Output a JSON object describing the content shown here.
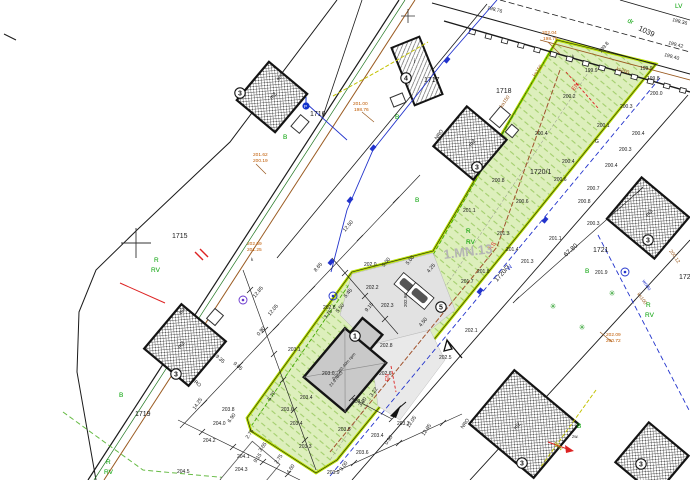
{
  "zone": {
    "label": "1.MN.13",
    "color": "#b5b5b5"
  },
  "parcels": [
    {
      "number": "1715"
    },
    {
      "number": "1716"
    },
    {
      "number": "1717"
    },
    {
      "number": "1718"
    },
    {
      "number": "1719"
    },
    {
      "number": "1720/1"
    },
    {
      "number": "1720/7"
    },
    {
      "number": "1721"
    },
    {
      "number": "1039"
    },
    {
      "number": "172"
    }
  ],
  "colors": {
    "line_black": "#1a1a1a",
    "parcel_green_fill": "#ddefbc",
    "parcel_green_border": "#b7e000",
    "landuse_green_text": "#00a000",
    "benchmark_orange": "#c05a00",
    "utility_blue": "#2233cc",
    "utility_brown": "#9a5a20",
    "utility_red": "#dd2222",
    "utility_yellow": "#c2c200",
    "building_gray": "#c9c9c9"
  },
  "building_markers": [
    {
      "n": "3",
      "x": 240,
      "y": 93
    },
    {
      "n": "3",
      "x": 176,
      "y": 374
    },
    {
      "n": "3",
      "x": 477,
      "y": 167
    },
    {
      "n": "4",
      "x": 406,
      "y": 78
    },
    {
      "n": "3",
      "x": 648,
      "y": 240
    },
    {
      "n": "3",
      "x": 522,
      "y": 463
    },
    {
      "n": "3",
      "x": 641,
      "y": 464
    },
    {
      "n": "1",
      "x": 355,
      "y": 336
    },
    {
      "n": "5",
      "x": 441,
      "y": 307
    }
  ],
  "trees": [
    {
      "x": 553,
      "y": 309
    },
    {
      "x": 612,
      "y": 296
    },
    {
      "x": 582,
      "y": 330
    }
  ],
  "well_symbols": [
    {
      "x": 243,
      "y": 300,
      "c": "#6633cc"
    },
    {
      "x": 625,
      "y": 272,
      "c": "#2233cc"
    },
    {
      "x": 333,
      "y": 296,
      "c": "#2233cc"
    }
  ],
  "valves": [
    {
      "x": 447,
      "y": 60
    },
    {
      "x": 373,
      "y": 148
    },
    {
      "x": 350,
      "y": 200
    },
    {
      "x": 545,
      "y": 220
    },
    {
      "x": 480,
      "y": 291
    },
    {
      "x": 331,
      "y": 262
    }
  ],
  "labels": [
    {
      "t": "198.76",
      "x": 487,
      "y": 9,
      "r": 15
    },
    {
      "t": "198.36",
      "x": 672,
      "y": 21,
      "r": 15
    },
    {
      "t": "199.42",
      "x": 668,
      "y": 44,
      "r": 15
    },
    {
      "t": "199.40",
      "x": 664,
      "y": 56,
      "r": 15
    },
    {
      "t": "199.8",
      "x": 601,
      "y": 53,
      "r": -50
    },
    {
      "t": "199.9",
      "x": 585,
      "y": 72
    },
    {
      "t": "199.9",
      "x": 640,
      "y": 70
    },
    {
      "t": "199.8",
      "x": 647,
      "y": 80
    },
    {
      "t": "200.0",
      "x": 650,
      "y": 95
    },
    {
      "t": "200.3",
      "x": 620,
      "y": 108
    },
    {
      "t": "200.2",
      "x": 563,
      "y": 98
    },
    {
      "t": "200.1",
      "x": 597,
      "y": 127
    },
    {
      "t": "200.4",
      "x": 535,
      "y": 135
    },
    {
      "t": "200.4",
      "x": 632,
      "y": 135
    },
    {
      "t": "200.3",
      "x": 619,
      "y": 151
    },
    {
      "t": "200.4",
      "x": 605,
      "y": 167
    },
    {
      "t": "200.7",
      "x": 587,
      "y": 190
    },
    {
      "t": "200.8",
      "x": 578,
      "y": 203
    },
    {
      "t": "200.4",
      "x": 562,
      "y": 163
    },
    {
      "t": "200.6",
      "x": 554,
      "y": 181
    },
    {
      "t": "200.8",
      "x": 492,
      "y": 182
    },
    {
      "t": "200.6",
      "x": 516,
      "y": 203
    },
    {
      "t": "201.1",
      "x": 463,
      "y": 212
    },
    {
      "t": "201.3",
      "x": 497,
      "y": 235
    },
    {
      "t": "201.3",
      "x": 521,
      "y": 263
    },
    {
      "t": "201.4",
      "x": 506,
      "y": 251
    },
    {
      "t": "201.1",
      "x": 549,
      "y": 240
    },
    {
      "t": "200.3",
      "x": 587,
      "y": 225
    },
    {
      "t": "201.9",
      "x": 595,
      "y": 274
    },
    {
      "t": "201.8",
      "x": 477,
      "y": 273
    },
    {
      "t": "201.7",
      "x": 461,
      "y": 283
    },
    {
      "t": "202.1",
      "x": 465,
      "y": 332
    },
    {
      "t": "202.5",
      "x": 439,
      "y": 359
    },
    {
      "t": "202.6",
      "x": 379,
      "y": 375
    },
    {
      "t": "202.0",
      "x": 364,
      "y": 266
    },
    {
      "t": "202.2",
      "x": 366,
      "y": 289
    },
    {
      "t": "202.3",
      "x": 381,
      "y": 307
    },
    {
      "t": "202.8",
      "x": 323,
      "y": 309
    },
    {
      "t": "202.8",
      "x": 380,
      "y": 347
    },
    {
      "t": "203.1",
      "x": 288,
      "y": 351
    },
    {
      "t": "203.4",
      "x": 300,
      "y": 399
    },
    {
      "t": "203.0",
      "x": 322,
      "y": 375
    },
    {
      "t": "203.2",
      "x": 352,
      "y": 403
    },
    {
      "t": "203.3",
      "x": 397,
      "y": 425
    },
    {
      "t": "203.4",
      "x": 371,
      "y": 437
    },
    {
      "t": "203.6",
      "x": 356,
      "y": 454
    },
    {
      "t": "203.9",
      "x": 327,
      "y": 474
    },
    {
      "t": "203.8",
      "x": 222,
      "y": 411
    },
    {
      "t": "203.6",
      "x": 281,
      "y": 411
    },
    {
      "t": "204.0",
      "x": 213,
      "y": 425
    },
    {
      "t": "204.2",
      "x": 203,
      "y": 442
    },
    {
      "t": "204.1",
      "x": 237,
      "y": 458
    },
    {
      "t": "204.3",
      "x": 235,
      "y": 471
    },
    {
      "t": "204.5",
      "x": 177,
      "y": 473
    },
    {
      "t": "203.5",
      "x": 338,
      "y": 431
    },
    {
      "t": "203.3",
      "x": 299,
      "y": 448
    },
    {
      "t": "203.4",
      "x": 290,
      "y": 425
    },
    {
      "t": "201.62",
      "x": 253,
      "y": 156,
      "c": "#c05a00",
      "s": 4.8
    },
    {
      "t": "200.19",
      "x": 253,
      "y": 162,
      "c": "#c05a00",
      "s": 4.8
    },
    {
      "t": "202.04",
      "x": 542,
      "y": 34,
      "c": "#c05a00",
      "s": 4.8
    },
    {
      "t": "198.76",
      "x": 543,
      "y": 40,
      "c": "#c05a00",
      "s": 4.8
    },
    {
      "t": "201.00",
      "x": 353,
      "y": 105,
      "c": "#c05a00",
      "s": 4.8
    },
    {
      "t": "198.76",
      "x": 354,
      "y": 111,
      "c": "#c05a00",
      "s": 4.8
    },
    {
      "t": "202.69",
      "x": 247,
      "y": 245,
      "c": "#c05a00",
      "s": 4.8
    },
    {
      "t": "201.25",
      "x": 247,
      "y": 251,
      "c": "#c05a00",
      "s": 4.8
    },
    {
      "t": "202.09",
      "x": 606,
      "y": 336,
      "c": "#c05a00",
      "s": 4.8
    },
    {
      "t": "200.72",
      "x": 606,
      "y": 342,
      "c": "#c05a00",
      "s": 4.8
    },
    {
      "t": "12.50",
      "x": 345,
      "y": 232,
      "r": -50,
      "s": 5.2
    },
    {
      "t": "12.85",
      "x": 255,
      "y": 298,
      "r": -50,
      "s": 5.2
    },
    {
      "t": "12.05",
      "x": 270,
      "y": 316,
      "r": -50,
      "s": 5.2
    },
    {
      "t": "0.90",
      "x": 259,
      "y": 336,
      "r": -50,
      "s": 5.2
    },
    {
      "t": "19.35",
      "x": 213,
      "y": 355,
      "r": 40,
      "s": 5.2
    },
    {
      "t": "9.05",
      "x": 233,
      "y": 364,
      "r": 40,
      "s": 5.2
    },
    {
      "t": "NRO",
      "x": 191,
      "y": 380,
      "r": 40,
      "s": 5
    },
    {
      "t": "14.25",
      "x": 195,
      "y": 410,
      "r": -55,
      "s": 5.2
    },
    {
      "t": "6.90",
      "x": 230,
      "y": 423,
      "r": -55,
      "s": 5.2
    },
    {
      "t": "2.75",
      "x": 248,
      "y": 439,
      "r": -55,
      "s": 5.2
    },
    {
      "t": "3.65",
      "x": 261,
      "y": 452,
      "r": -55,
      "s": 5.2
    },
    {
      "t": "9.15",
      "x": 256,
      "y": 463,
      "r": -55,
      "s": 5.2
    },
    {
      "t": "2.75",
      "x": 277,
      "y": 464,
      "r": -55,
      "s": 5.2
    },
    {
      "t": "4.60",
      "x": 289,
      "y": 474,
      "r": -55,
      "s": 5.2
    },
    {
      "t": "5.70",
      "x": 270,
      "y": 401,
      "r": -55,
      "s": 5.2
    },
    {
      "t": "12.05",
      "x": 409,
      "y": 428,
      "r": -55,
      "s": 5.2
    },
    {
      "t": "12.95",
      "x": 424,
      "y": 436,
      "r": -55,
      "s": 5.2
    },
    {
      "t": "0.90",
      "x": 387,
      "y": 445,
      "r": -55,
      "s": 5.2
    },
    {
      "t": "3.00",
      "x": 342,
      "y": 471,
      "r": -55,
      "s": 5.2
    },
    {
      "t": "3.22",
      "x": 372,
      "y": 397,
      "r": -55,
      "s": 5.2
    },
    {
      "t": "3.10",
      "x": 361,
      "y": 407,
      "r": -55,
      "s": 5.2
    },
    {
      "t": "5.45",
      "x": 346,
      "y": 298,
      "r": -50,
      "s": 5.2
    },
    {
      "t": "5.50",
      "x": 338,
      "y": 313,
      "r": -50,
      "s": 5.2
    },
    {
      "t": "3.15",
      "x": 326,
      "y": 319,
      "r": -50,
      "s": 5.2
    },
    {
      "t": "9.15",
      "x": 367,
      "y": 312,
      "r": -50,
      "s": 5.2
    },
    {
      "t": "8.65",
      "x": 316,
      "y": 272,
      "r": -50,
      "s": 5.2
    },
    {
      "t": "4.50",
      "x": 421,
      "y": 327,
      "r": -50,
      "s": 5.2
    },
    {
      "t": "4.25",
      "x": 429,
      "y": 273,
      "r": -50,
      "s": 5.2
    },
    {
      "t": "5.00",
      "x": 384,
      "y": 267,
      "r": -50,
      "s": 5.2
    },
    {
      "t": "5.00",
      "x": 408,
      "y": 265,
      "r": -50,
      "s": 5.2
    },
    {
      "t": "67.80",
      "x": 566,
      "y": 257,
      "r": -42,
      "s": 6.5
    },
    {
      "t": "KS",
      "x": 491,
      "y": 250,
      "r": -50,
      "c": "#dd2222",
      "s": 6
    },
    {
      "t": "W",
      "x": 509,
      "y": 271,
      "r": -50,
      "c": "#2233cc",
      "s": 6
    },
    {
      "t": "EN",
      "x": 574,
      "y": 91,
      "r": -50,
      "c": "#dd2222",
      "s": 6
    },
    {
      "t": "EN",
      "x": 389,
      "y": 381,
      "r": -90,
      "c": "#dd2222",
      "s": 5
    },
    {
      "t": "wodo",
      "x": 642,
      "y": 281,
      "r": 55,
      "c": "#2233cc",
      "s": 5
    },
    {
      "t": "ks150",
      "x": 535,
      "y": 77,
      "r": -55,
      "c": "#9a5a20",
      "s": 5
    },
    {
      "t": "ka150",
      "x": 502,
      "y": 108,
      "r": -55,
      "c": "#9a5a20",
      "s": 5
    },
    {
      "t": "ks200",
      "x": 616,
      "y": 70,
      "r": 18,
      "c": "#9a5a20",
      "s": 5
    },
    {
      "t": "ks100",
      "x": 637,
      "y": 294,
      "r": 55,
      "c": "#9a5a20",
      "s": 5
    },
    {
      "t": "200.12",
      "x": 669,
      "y": 251,
      "r": 55,
      "c": "#9a5a20",
      "s": 5
    },
    {
      "t": "eNN",
      "x": 554,
      "y": 443,
      "r": 50,
      "c": "#b0a800",
      "s": 5
    },
    {
      "t": "zw.",
      "x": 572,
      "y": 438,
      "s": 4.5
    },
    {
      "t": "G",
      "x": 595,
      "y": 143,
      "s": 5
    },
    {
      "t": "k",
      "x": 251,
      "y": 261,
      "s": 4.5
    },
    {
      "t": "k",
      "x": 572,
      "y": 58,
      "s": 4.5
    },
    {
      "t": "982",
      "x": 279,
      "y": 81,
      "r": -55,
      "s": 4.5
    },
    {
      "t": "492",
      "x": 181,
      "y": 315,
      "r": -55,
      "s": 4.5
    },
    {
      "t": "202.96",
      "x": 407,
      "y": 307,
      "r": -90,
      "s": 4.5
    },
    {
      "t": "0.0=203.40m npm",
      "x": 334,
      "y": 380,
      "r": -50,
      "s": 4.2
    },
    {
      "t": "21.9  NRO",
      "x": 331,
      "y": 387,
      "r": -50,
      "s": 4.2
    },
    {
      "t": "m2",
      "x": 272,
      "y": 100,
      "r": -50,
      "s": 5.5
    },
    {
      "t": "m2",
      "x": 180,
      "y": 349,
      "r": -50,
      "s": 5.5
    },
    {
      "t": "m2",
      "x": 471,
      "y": 147,
      "r": -50,
      "s": 5.5
    },
    {
      "t": "m2",
      "x": 648,
      "y": 217,
      "r": -50,
      "s": 5.5
    },
    {
      "t": "m2",
      "x": 516,
      "y": 430,
      "r": -50,
      "s": 5.5
    },
    {
      "t": "NRO",
      "x": 437,
      "y": 140,
      "r": -55,
      "s": 5
    },
    {
      "t": "NRO",
      "x": 463,
      "y": 429,
      "r": -55,
      "s": 5
    },
    {
      "t": "i",
      "x": 414,
      "y": 63,
      "s": 6
    },
    {
      "t": "P",
      "x": 304,
      "y": 108,
      "c": "#ffffff",
      "s": 4.5
    },
    {
      "t": "B",
      "x": 283,
      "y": 139,
      "c": "#00a000",
      "s": 6.5
    },
    {
      "t": "B",
      "x": 395,
      "y": 119,
      "c": "#00a000",
      "s": 6.5
    },
    {
      "t": "B",
      "x": 415,
      "y": 202,
      "c": "#00a000",
      "s": 6.5
    },
    {
      "t": "B",
      "x": 119,
      "y": 397,
      "c": "#00a000",
      "s": 6.5
    },
    {
      "t": "B",
      "x": 585,
      "y": 273,
      "c": "#00a000",
      "s": 6.5
    },
    {
      "t": "B",
      "x": 577,
      "y": 428,
      "c": "#00a000",
      "s": 6.5
    },
    {
      "t": "R",
      "x": 154,
      "y": 262,
      "c": "#00a000",
      "s": 6.5
    },
    {
      "t": "RV",
      "x": 151,
      "y": 272,
      "c": "#00a000",
      "s": 6.5
    },
    {
      "t": "R",
      "x": 466,
      "y": 233,
      "c": "#00a000",
      "s": 6.5
    },
    {
      "t": "RV",
      "x": 466,
      "y": 244,
      "c": "#00a000",
      "s": 6.5
    },
    {
      "t": "R",
      "x": 646,
      "y": 307,
      "c": "#00a000",
      "s": 6.5
    },
    {
      "t": "RV",
      "x": 645,
      "y": 317,
      "c": "#00a000",
      "s": 6.5
    },
    {
      "t": "R",
      "x": 106,
      "y": 464,
      "c": "#00a000",
      "s": 6.5
    },
    {
      "t": "RV",
      "x": 104,
      "y": 474,
      "c": "#00a000",
      "s": 6.5
    },
    {
      "t": "LV",
      "x": 675,
      "y": 8,
      "c": "#00a000",
      "s": 6.5
    },
    {
      "t": "dr",
      "x": 627,
      "y": 22,
      "r": 25,
      "c": "#00a000",
      "s": 6.5
    }
  ]
}
